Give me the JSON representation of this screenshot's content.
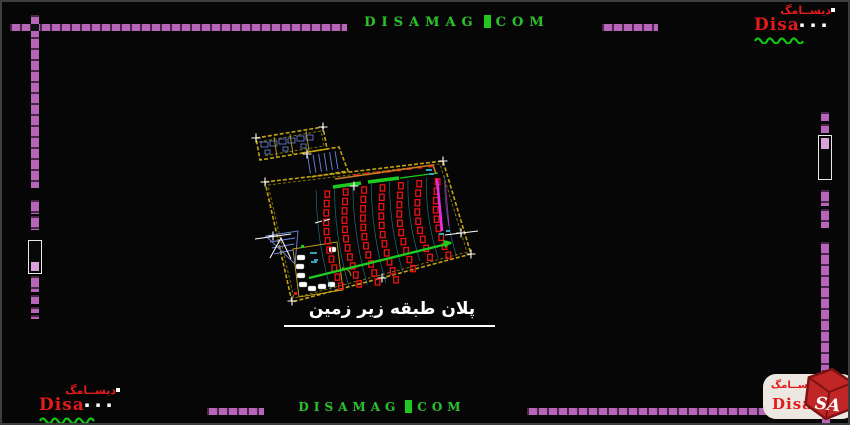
{
  "page": {
    "background": "#060606",
    "frame_color": "#3e3e3e",
    "accent_purple": "#b765b7",
    "thumb_purple": "#d9a2d9"
  },
  "watermark": {
    "name": "DISAMAG",
    "tld": "COM",
    "color": "#22c822"
  },
  "brand": {
    "persian": "دیســامگ",
    "latin": "Disa",
    "latin_suffix": "mag",
    "marks": "▪ ▪ ▪",
    "icon_text": "SA",
    "red": "#e31b1b",
    "wave_green": "#14c414",
    "pill_bg": "#ece8e1"
  },
  "plan": {
    "caption": "پلان طبقه زیر زمین",
    "seating": {
      "columns": 7,
      "column_seat_counts": [
        11,
        11,
        11,
        11,
        10,
        9,
        9
      ],
      "spacing": 18.5,
      "color": "#ef1212"
    },
    "colors": {
      "walls": "#c4a312",
      "walls_dark": "#8a7a10",
      "green": "#1ecb1e",
      "magenta": "#e62ce6",
      "blue": "#6f86de",
      "cyan": "#2fa3b8",
      "orange": "#c87a20",
      "white": "#ffffff"
    }
  }
}
